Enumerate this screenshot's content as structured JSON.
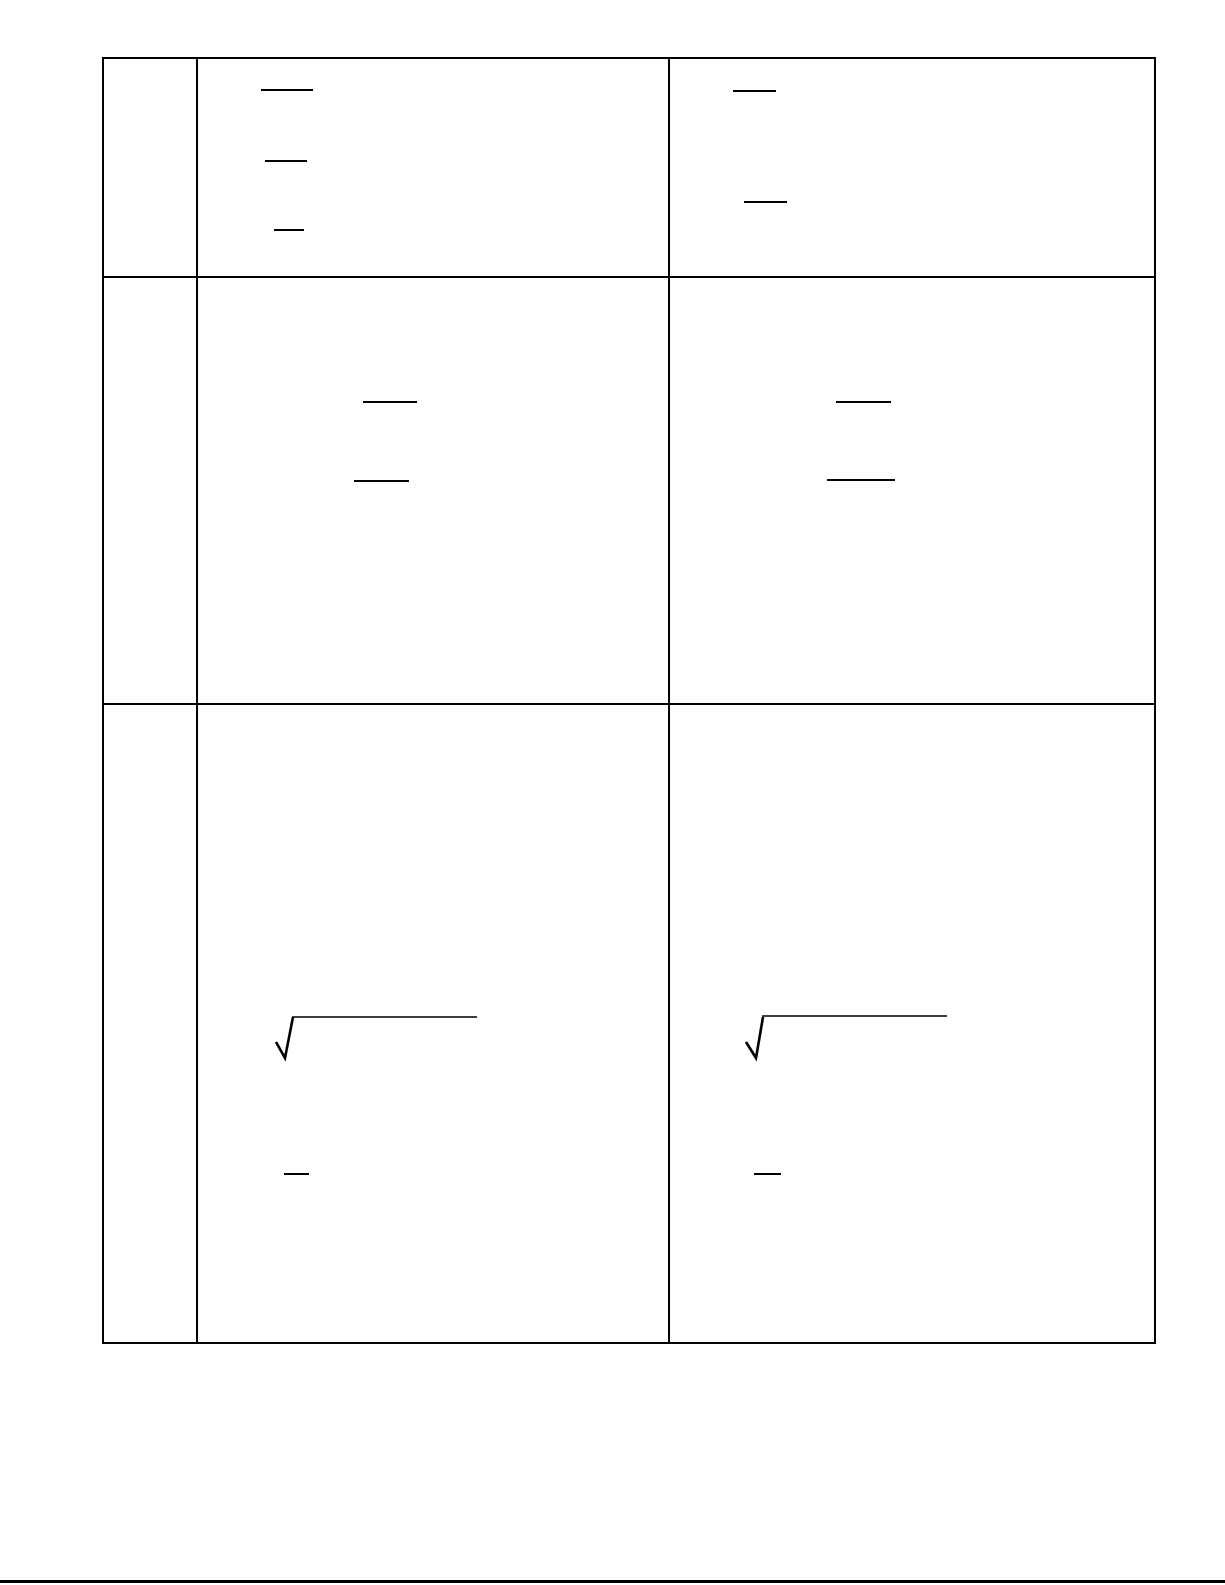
{
  "page": {
    "width": 1225,
    "height": 1585,
    "background_color": "#ffffff",
    "ink_color": "#000000",
    "visible_text": ""
  },
  "table": {
    "description": "3-row by 3-column ruled table, all cells blank except math stroke remnants",
    "x": 102,
    "y": 57,
    "width": 1054,
    "height": 1287,
    "column_edges": [
      103,
      197,
      669,
      1155
    ],
    "row_edges": [
      58,
      277,
      704,
      1343
    ],
    "row_count": 3,
    "column_count": 3,
    "border_thickness": 2
  },
  "marks": {
    "fraction_bars": [
      {
        "row": 1,
        "column": 2,
        "x": 261,
        "y": 89,
        "width": 52,
        "thickness": 2
      },
      {
        "row": 1,
        "column": 2,
        "x": 265,
        "y": 160,
        "width": 42,
        "thickness": 2
      },
      {
        "row": 1,
        "column": 2,
        "x": 274,
        "y": 229,
        "width": 30,
        "thickness": 2
      },
      {
        "row": 1,
        "column": 3,
        "x": 733,
        "y": 90,
        "width": 43,
        "thickness": 2
      },
      {
        "row": 1,
        "column": 3,
        "x": 744,
        "y": 201,
        "width": 43,
        "thickness": 2
      },
      {
        "row": 2,
        "column": 2,
        "x": 363,
        "y": 401,
        "width": 54,
        "thickness": 2
      },
      {
        "row": 2,
        "column": 2,
        "x": 354,
        "y": 480,
        "width": 55,
        "thickness": 2
      },
      {
        "row": 2,
        "column": 3,
        "x": 836,
        "y": 401,
        "width": 55,
        "thickness": 2
      },
      {
        "row": 2,
        "column": 3,
        "x": 827,
        "y": 479,
        "width": 68,
        "thickness": 2
      },
      {
        "row": 3,
        "column": 2,
        "x": 284,
        "y": 1173,
        "width": 25,
        "thickness": 2
      },
      {
        "row": 3,
        "column": 3,
        "x": 754,
        "y": 1173,
        "width": 27,
        "thickness": 2
      }
    ],
    "radicals": [
      {
        "row": 3,
        "column": 2,
        "tick_points": "276,1042 285,1058 293,1017",
        "bar_points": "292,1017 477,1017",
        "tick_stroke": 2.6,
        "bar_stroke": 1.4
      },
      {
        "row": 3,
        "column": 3,
        "tick_points": "746,1042 756,1058 763,1017",
        "bar_points": "762,1016 947,1016",
        "tick_stroke": 2.6,
        "bar_stroke": 1.4
      }
    ]
  },
  "footer_rule": {
    "x": 0,
    "y": 1580,
    "width": 1225,
    "thickness": 3
  }
}
